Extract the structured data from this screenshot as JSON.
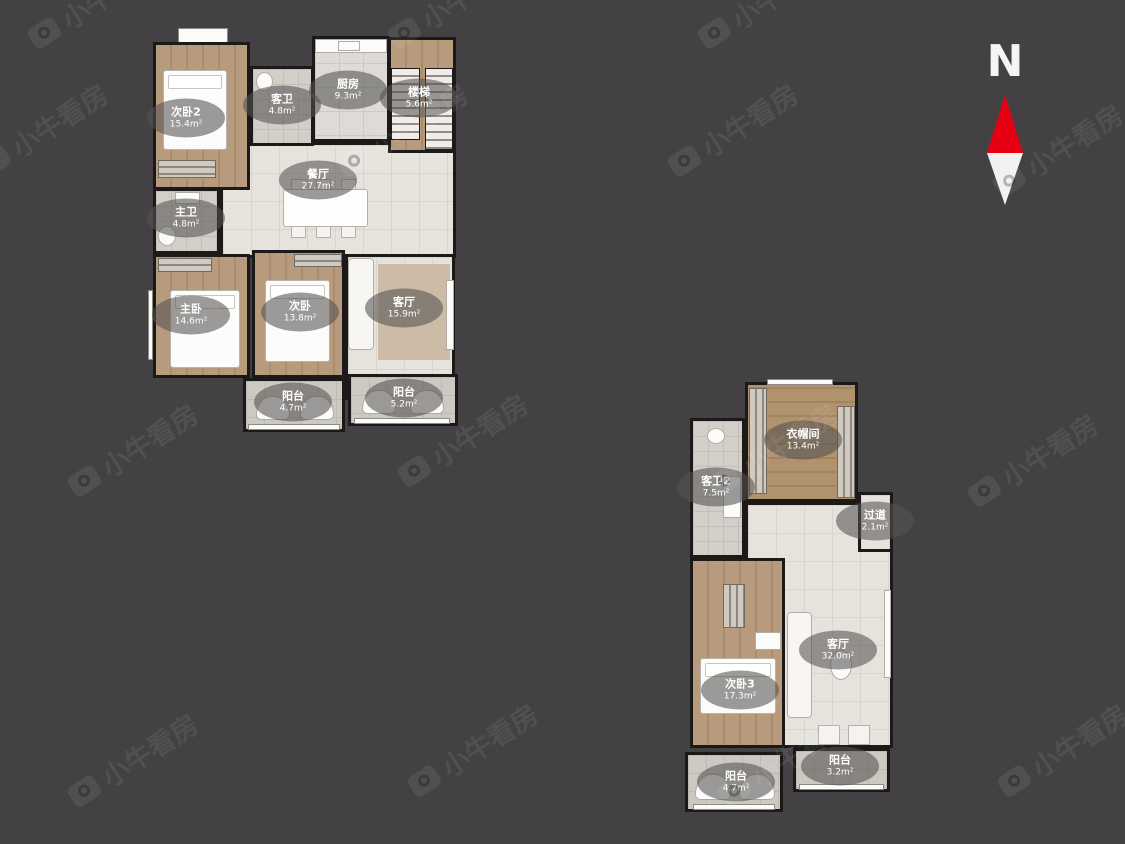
{
  "compass": {
    "label": "N"
  },
  "watermark": {
    "text": "小牛看房"
  },
  "colors": {
    "background": "#434144",
    "wall": "#1b1a19",
    "wood_floor": "#b79b7c",
    "tile_floor": "#e6e3dd",
    "bath_floor": "#d2cec8",
    "balcony_floor": "#ccc8c2",
    "label_bubble": "rgba(85,83,81,0.58)",
    "label_text": "#ffffff",
    "compass_red": "#e60012",
    "compass_white": "#f2f1ef"
  },
  "floor1": {
    "rooms": [
      {
        "label": "次卧2",
        "area": "15.4m²"
      },
      {
        "label": "客卫",
        "area": "4.8m²"
      },
      {
        "label": "厨房",
        "area": "9.3m²"
      },
      {
        "label": "楼梯",
        "area": "5.6m²"
      },
      {
        "label": "餐厅",
        "area": "27.7m²"
      },
      {
        "label": "主卫",
        "area": "4.8m²"
      },
      {
        "label": "主卧",
        "area": "14.6m²"
      },
      {
        "label": "次卧",
        "area": "13.8m²"
      },
      {
        "label": "客厅",
        "area": "15.9m²"
      },
      {
        "label": "阳台",
        "area": "4.7m²"
      },
      {
        "label": "阳台",
        "area": "5.2m²"
      }
    ]
  },
  "floor2": {
    "rooms": [
      {
        "label": "衣帽间",
        "area": "13.4m²"
      },
      {
        "label": "客卫2",
        "area": "7.5m²"
      },
      {
        "label": "过道",
        "area": "2.1m²"
      },
      {
        "label": "客厅",
        "area": "32.0m²"
      },
      {
        "label": "次卧3",
        "area": "17.3m²"
      },
      {
        "label": "阳台",
        "area": "3.2m²"
      },
      {
        "label": "阳台",
        "area": "4.7m²"
      }
    ]
  }
}
